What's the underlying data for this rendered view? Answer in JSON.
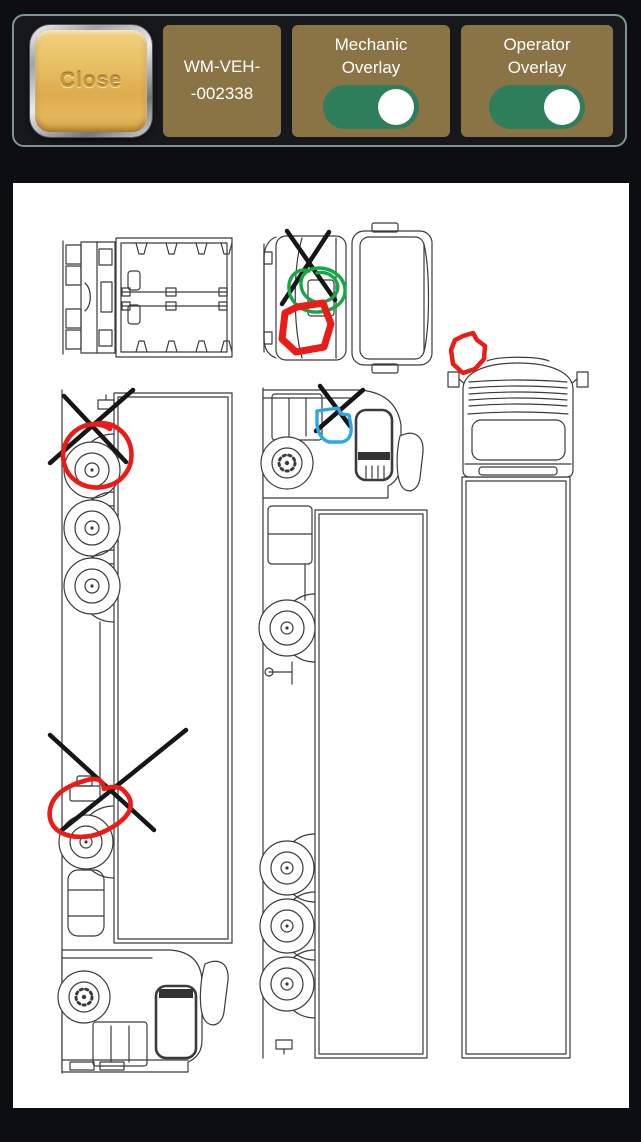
{
  "header": {
    "close_button": {
      "label": "Close"
    },
    "vehicle_id": {
      "line1": "WM-VEH-",
      "line2": "-002338"
    },
    "toggles": [
      {
        "name": "mechanic-overlay",
        "label": "Mechanic Overlay",
        "state": "on"
      },
      {
        "name": "operator-overlay",
        "label": "Operator Overlay",
        "state": "on"
      }
    ]
  },
  "colors": {
    "page_bg": "#0d0e11",
    "toolbar_border": "#7f958d",
    "panel_gold": "#8a7345",
    "toggle_on_green": "#2e7d5b",
    "close_gold": "#e7be62",
    "canvas_bg": "#ffffff",
    "line_art": "#3b3b3b",
    "mark_black": "#161616",
    "mark_red": "#e91c17",
    "mark_green": "#17a845",
    "mark_blue": "#2aa7e6"
  },
  "canvas": {
    "views": [
      {
        "id": "view-top-rig",
        "desc": "top view of tractor and trailer"
      },
      {
        "id": "view-top-cab",
        "desc": "top view of cab"
      },
      {
        "id": "view-front",
        "desc": "front view of cab and trailer"
      },
      {
        "id": "view-side-left",
        "desc": "side view rotated, cab at bottom"
      },
      {
        "id": "view-side-right",
        "desc": "side view rotated, cab at top"
      }
    ],
    "marks": [
      {
        "id": "x-mark-top-cab",
        "tool": "x",
        "color_key": "mark_black",
        "width": 4.5,
        "lines": [
          [
            287,
            231,
            335,
            300
          ],
          [
            329,
            232,
            282,
            304
          ]
        ]
      },
      {
        "id": "scribble-green-top-cab",
        "tool": "scribble",
        "color_key": "mark_green",
        "width": 3.4,
        "path": "M309,271 C297,267 288,277 289,289 C290,303 303,313 318,312 C334,311 346,302 345,289 C344,277 332,268 319,268 C308,268 300,275 301,285 C302,296 312,304 323,302 C333,300 340,292 337,283 C334,275 325,271 317,273"
      },
      {
        "id": "outline-red-top-cab",
        "tool": "outline",
        "color_key": "mark_red",
        "width": 7,
        "path": "M297,307 L323,303 L331,324 L324,347 L296,352 L282,339 L285,313 Z"
      },
      {
        "id": "scribble-red-front",
        "tool": "outline",
        "color_key": "mark_red",
        "width": 4.5,
        "path": "M463,336 L473,333 L477,340 L485,346 L484,359 L475,369 L463,373 L453,364 L451,350 L455,340 Z"
      },
      {
        "id": "x-mark-left-top",
        "tool": "x",
        "color_key": "mark_black",
        "width": 4.5,
        "lines": [
          [
            64,
            396,
            126,
            462
          ],
          [
            133,
            390,
            50,
            463
          ]
        ]
      },
      {
        "id": "circle-red-left-top",
        "tool": "circle",
        "color_key": "mark_red",
        "width": 4.6,
        "path": "M95,424 C112,420 128,432 131,449 C134,468 122,484 103,487 C85,490 68,480 64,463 C60,447 69,432 84,426 C92,423 103,424 110,429"
      },
      {
        "id": "x-mark-left-bottom",
        "tool": "x",
        "color_key": "mark_black",
        "width": 4.5,
        "lines": [
          [
            50,
            735,
            154,
            830
          ],
          [
            186,
            730,
            62,
            830
          ]
        ]
      },
      {
        "id": "loop-red-left-bottom",
        "tool": "outline",
        "color_key": "mark_red",
        "width": 4.6,
        "path": "M84,781 C92,778 100,778 103,784 L104,789 C112,786 120,786 124,791 C129,796 132,801 130,809 C127,818 116,826 103,832 C90,838 72,839 60,832 C50,826 47,815 52,803 C57,792 70,785 84,781 Z"
      },
      {
        "id": "x-mark-middle-cab",
        "tool": "x",
        "color_key": "mark_black",
        "width": 4.5,
        "lines": [
          [
            320,
            386,
            350,
            426
          ],
          [
            363,
            390,
            316,
            431
          ]
        ]
      },
      {
        "id": "loop-blue-middle-cab",
        "tool": "outline",
        "color_key": "mark_blue",
        "width": 3.4,
        "path": "M317,411 L338,408 L341,414 L349,415 L351,426 C352,435 349,441 341,442 L329,442 C322,440 318,433 317,425 Z"
      }
    ]
  }
}
